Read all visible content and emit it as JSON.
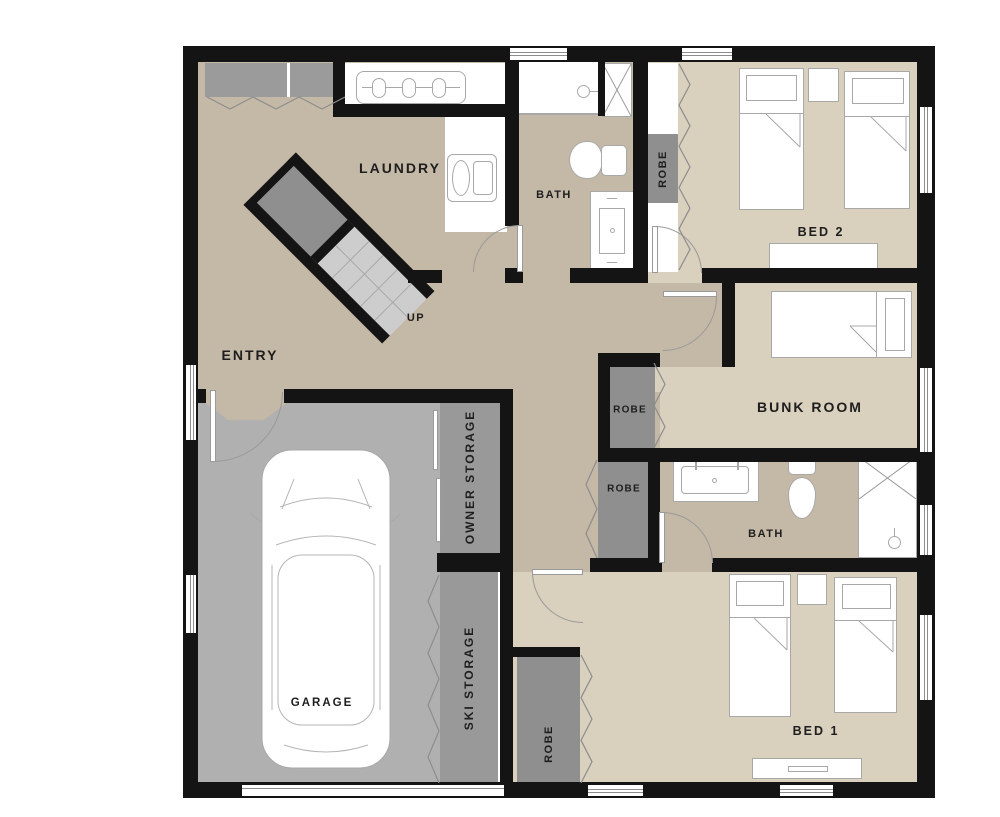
{
  "floor_plan": {
    "rooms": {
      "laundry": {
        "label": "LAUNDRY"
      },
      "bath_upper": {
        "label": "BATH"
      },
      "bed2": {
        "label": "BED 2"
      },
      "bunk_room": {
        "label": "BUNK ROOM"
      },
      "bath_lower": {
        "label": "BATH"
      },
      "bed1": {
        "label": "BED 1"
      },
      "entry": {
        "label": "ENTRY"
      },
      "garage": {
        "label": "GARAGE"
      },
      "owner_storage": {
        "label": "OWNER STORAGE"
      },
      "ski_storage": {
        "label": "SKI STORAGE"
      }
    },
    "closets": {
      "robe_bed2": {
        "label": "ROBE"
      },
      "robe_bunk": {
        "label": "ROBE"
      },
      "robe_hall": {
        "label": "ROBE"
      },
      "robe_bed1": {
        "label": "ROBE"
      }
    },
    "stairs": {
      "label": "UP"
    },
    "colors": {
      "wall": "#141414",
      "hall_floor": "#c4b8a6",
      "bedroom_floor": "#d9d0bd",
      "garage_floor": "#b0b0b0",
      "storage_floor": "#999999",
      "robe_fill": "#8f8f8f",
      "closet_fill": "#9b9b9b",
      "fixture_outline": "#a8a8a8",
      "label_text": "#1e1e1e"
    }
  }
}
